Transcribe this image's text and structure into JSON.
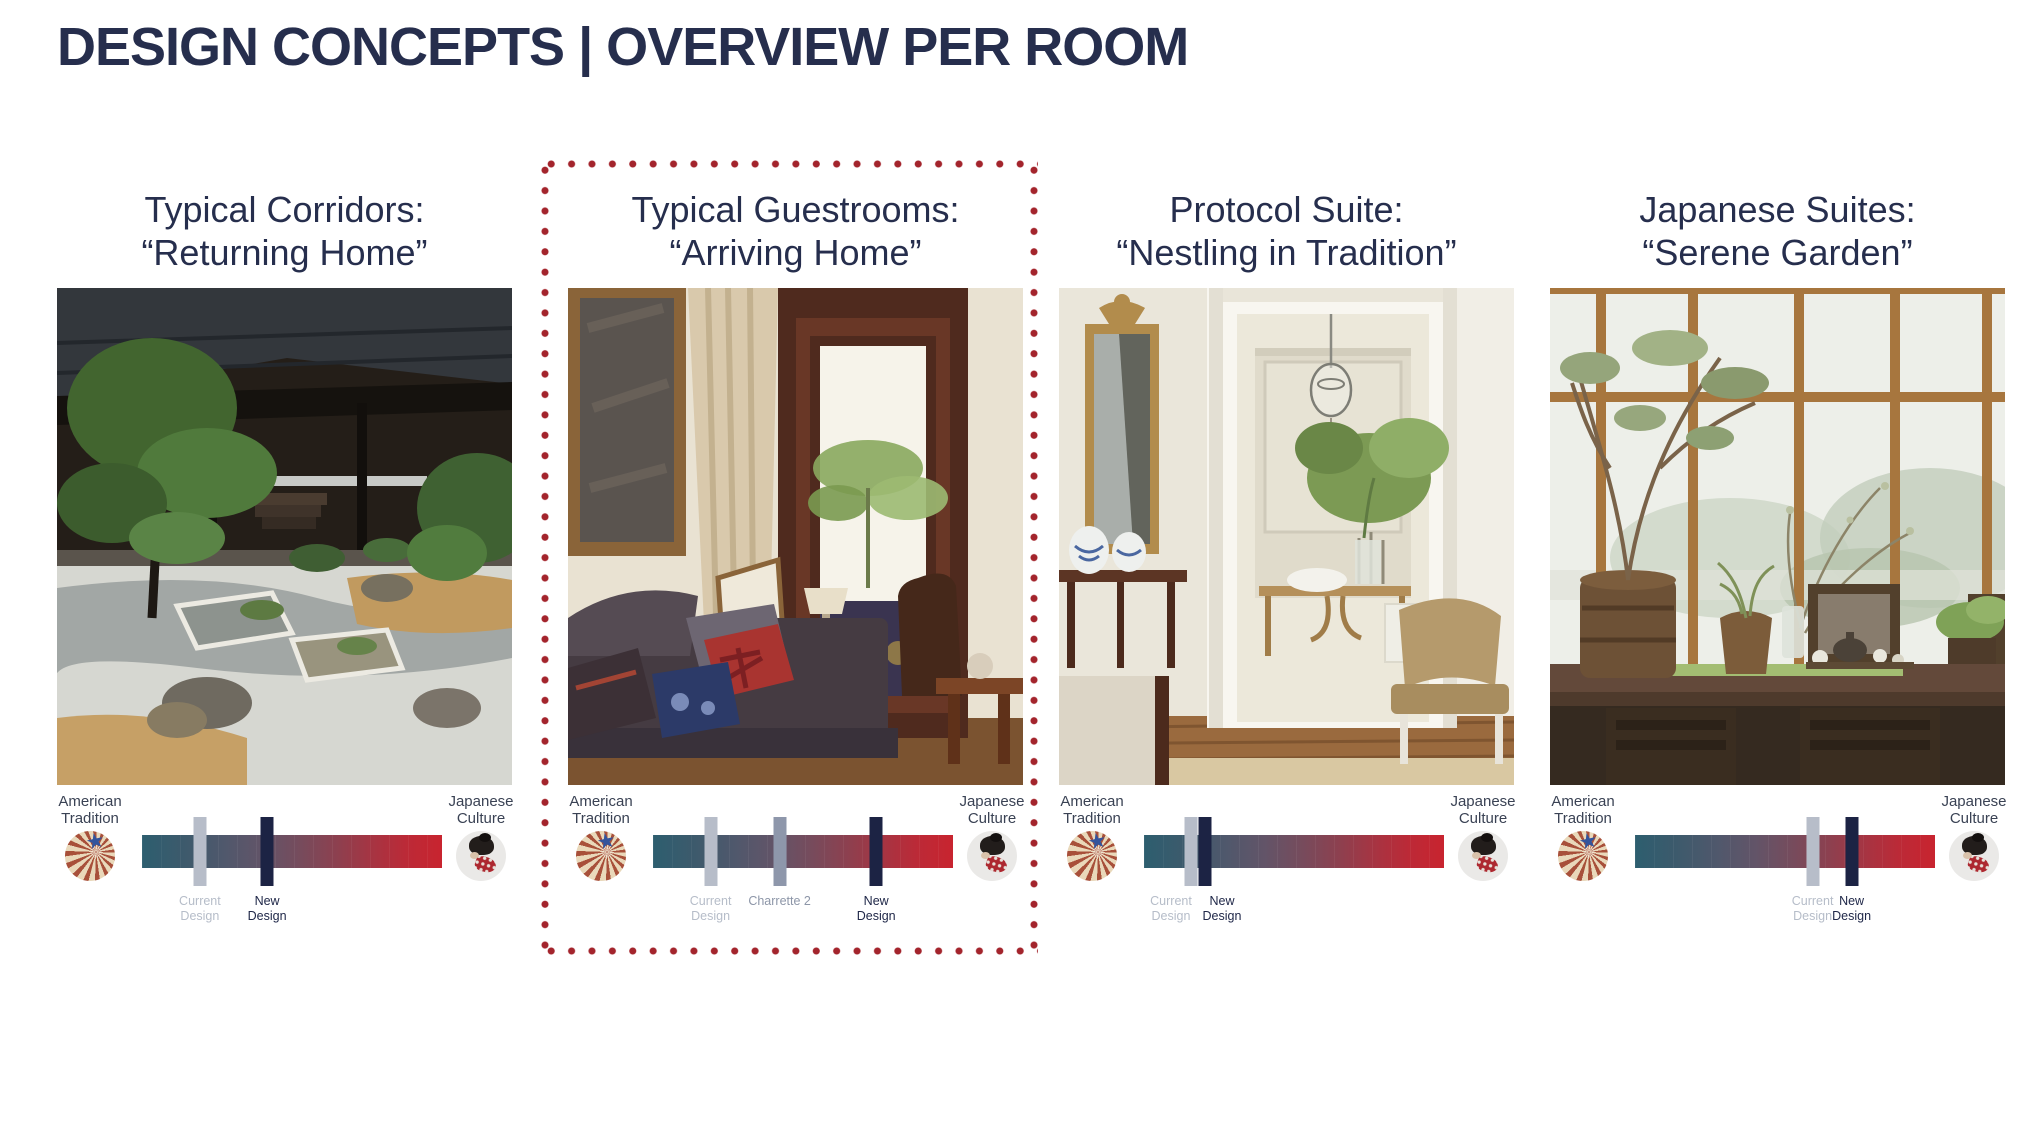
{
  "title": "DESIGN CONCEPTS | OVERVIEW PER ROOM",
  "scale": {
    "left_label": "American Tradition",
    "right_label": "Japanese Culture",
    "left_icon": "american-fan-icon",
    "right_icon": "japanese-geisha-icon"
  },
  "colors": {
    "title_navy": "#262e4d",
    "dotted_accent_red": "#a3242c",
    "bar_teal_end": "#2d5e6f",
    "bar_red_end": "#c8242f",
    "marker_current_gray": "#b7bdc9",
    "marker_charrette_slate": "#8e97ab",
    "marker_new_navy": "#1c2344"
  },
  "columns": [
    {
      "id": "typical-corridors",
      "title_line1": "Typical Corridors:",
      "title_line2": "“Returning Home”",
      "highlighted": false,
      "image": "japanese-temple-zen-garden",
      "markers": [
        {
          "label": "Current Design",
          "type": "current",
          "pos": 19.3,
          "label_pos": 19.3
        },
        {
          "label": "New Design",
          "type": "new",
          "pos": 41.7,
          "label_pos": 41.7
        }
      ]
    },
    {
      "id": "typical-guestrooms",
      "title_line1": "Typical Guestrooms:",
      "title_line2": "“Arriving Home”",
      "highlighted": true,
      "image": "guestroom-sofa-window",
      "markers": [
        {
          "label": "Current Design",
          "type": "current",
          "pos": 19.2,
          "label_pos": 19.2
        },
        {
          "label": "Charrette 2",
          "type": "charrette",
          "pos": 42.2,
          "label_pos": 42.2
        },
        {
          "label": "New Design",
          "type": "new",
          "pos": 74.4,
          "label_pos": 74.4
        }
      ]
    },
    {
      "id": "protocol-suite",
      "title_line1": "Protocol Suite:",
      "title_line2": "“Nestling in Tradition”",
      "highlighted": false,
      "image": "classic-suite-mirror-dining",
      "markers": [
        {
          "label": "Current Design",
          "type": "current",
          "pos": 15.7,
          "label_pos": 9
        },
        {
          "label": "New Design",
          "type": "new",
          "pos": 20.3,
          "label_pos": 26
        }
      ]
    },
    {
      "id": "japanese-suites",
      "title_line1": "Japanese Suites:",
      "title_line2": "“Serene Garden”",
      "highlighted": false,
      "image": "tea-table-large-window",
      "markers": [
        {
          "label": "Current Design",
          "type": "current",
          "pos": 59.2,
          "label_pos": 59.2
        },
        {
          "label": "New Design",
          "type": "new",
          "pos": 72.2,
          "label_pos": 72.2
        }
      ]
    }
  ]
}
